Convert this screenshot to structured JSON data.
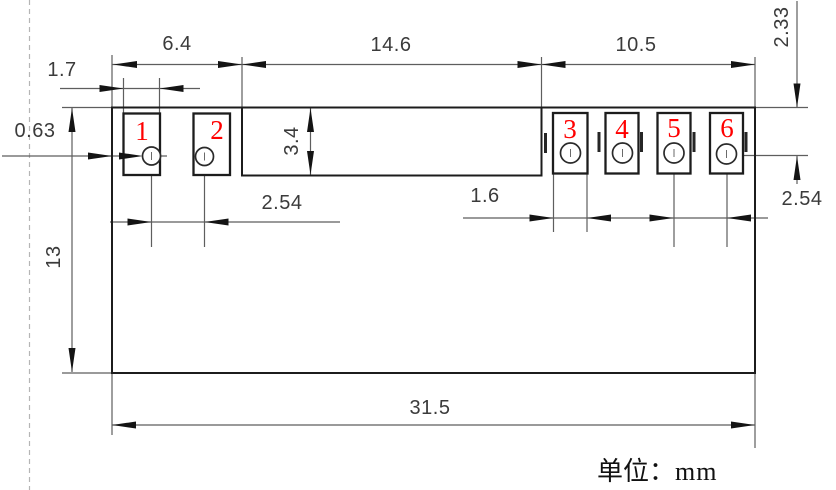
{
  "pads": [
    {
      "number": "1"
    },
    {
      "number": "2"
    },
    {
      "number": "3"
    },
    {
      "number": "4"
    },
    {
      "number": "5"
    },
    {
      "number": "6"
    }
  ],
  "dimensions": {
    "left_section_width": "6.4",
    "middle_section_width": "14.6",
    "right_section_width": "10.5",
    "left_pad_width": "1.7",
    "left_edge_to_pad": "0.63",
    "middle_block_height": "3.4",
    "body_height": "13",
    "left_pad_pitch": "2.54",
    "right_pad_width": "1.6",
    "top_edge_to_hole_center": "2.33",
    "right_pad_pitch": "2.54",
    "overall_width": "31.5"
  },
  "unit_note": {
    "prefix": "单位：",
    "unit": "mm"
  },
  "colors": {
    "outline": "#1c1c1c",
    "dimension_line": "#5e5e5e",
    "pad_number": "#ff0000",
    "centerline_dashed": "#b5b5b5",
    "background": "#ffffff"
  }
}
